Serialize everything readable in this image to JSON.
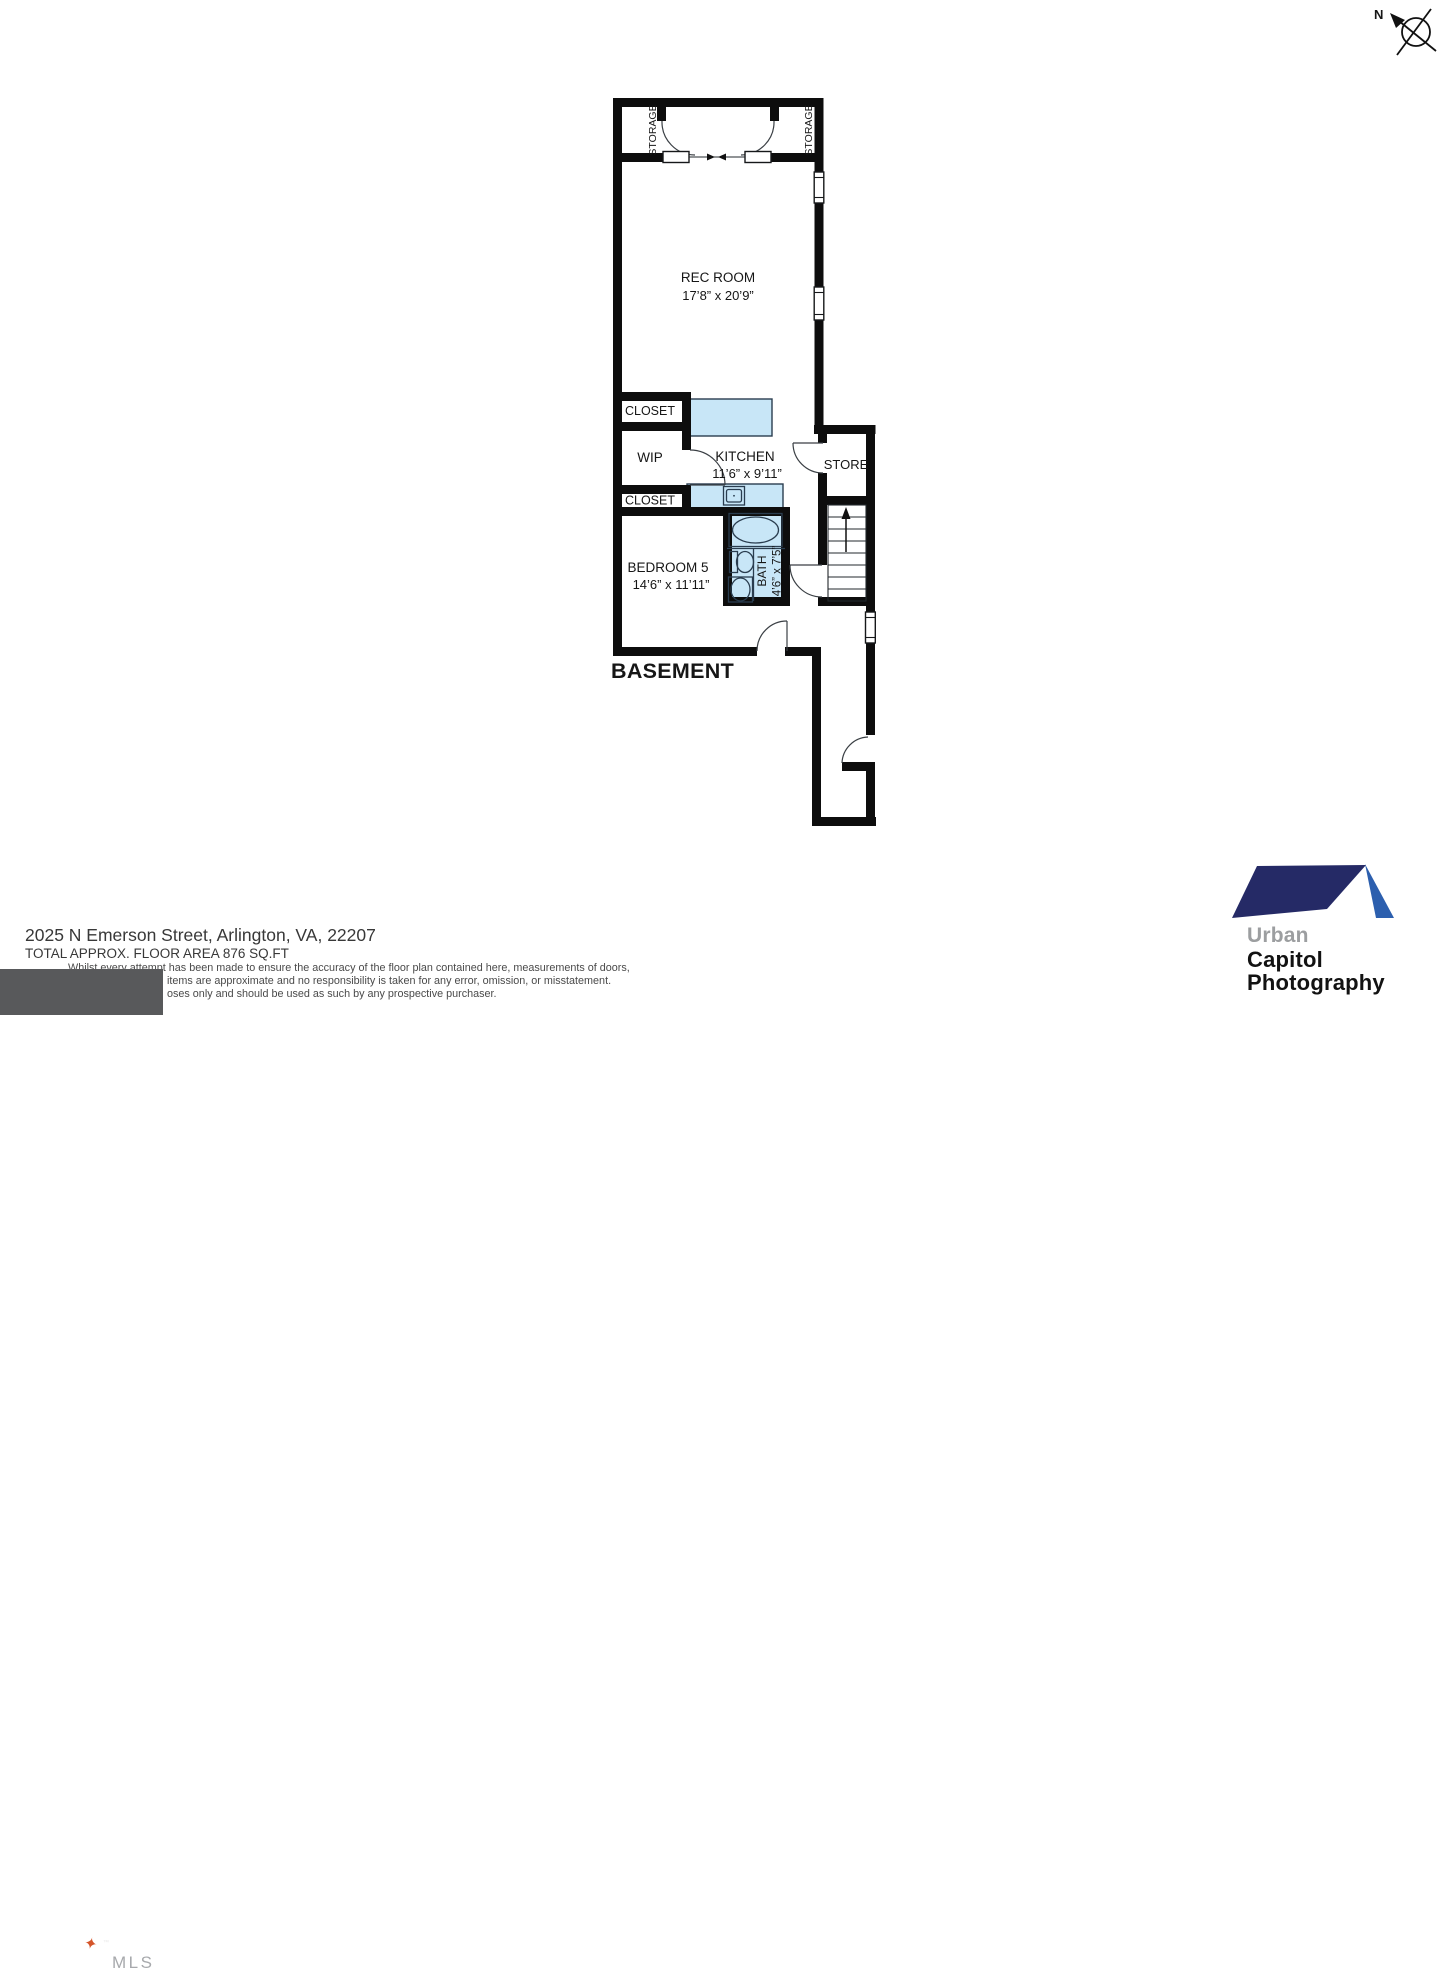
{
  "compass": {
    "north_label": "N"
  },
  "plan": {
    "floor_label": "BASEMENT",
    "rec_room": {
      "name": "REC ROOM",
      "dims": "17’8” x 20’9”"
    },
    "kitchen": {
      "name": "KITCHEN",
      "dims": "11’6” x 9’11”"
    },
    "bedroom": {
      "name": "BEDROOM 5",
      "dims": "14’6” x 11’11”"
    },
    "bath": {
      "name": "BATH",
      "dims": "4’6” x 7’5”"
    },
    "wip": {
      "name": "WIP"
    },
    "store": {
      "name": "STORE"
    },
    "closet_upper": {
      "name": "CLOSET"
    },
    "closet_lower": {
      "name": "CLOSET"
    },
    "storage_left": {
      "name": "STORAGE"
    },
    "storage_right": {
      "name": "STORAGE"
    }
  },
  "footer": {
    "address": "2025 N Emerson Street, Arlington, VA, 22207",
    "floor_area": "TOTAL APPROX. FLOOR AREA 876 SQ.FT",
    "disclaimer_line1": "Whilst every attempt has been made to ensure the accuracy of the floor plan contained here, measurements of doors,",
    "disclaimer_line2": "items are approximate and no responsibility is taken for any error, omission, or misstatement.",
    "disclaimer_line3": "oses only and should be used as such by any prospective purchaser."
  },
  "logos": {
    "bright_mls": {
      "word": "bright",
      "tm": "™",
      "suffix": "MLS",
      "star": "✦"
    },
    "urban_capitol": {
      "line1": "Urban",
      "line2": "Capitol",
      "line3": "Photography"
    }
  },
  "colors": {
    "wall": "#0d0d0d",
    "fixture_fill": "#c8e6f7",
    "fixture_stroke": "#2a3d4f",
    "bright_box": "#58595b",
    "bright_star": "#d4552a",
    "roof_dark": "#252a66",
    "roof_light": "#2c5fae"
  }
}
